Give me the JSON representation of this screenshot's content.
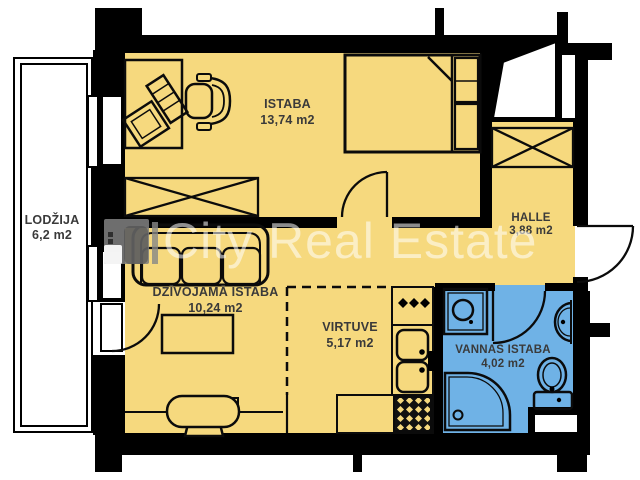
{
  "rooms": {
    "lodzija": {
      "name": "LODŽIJA",
      "area": "6,2 m2"
    },
    "istaba": {
      "name": "ISTABA",
      "area": "13,74 m2"
    },
    "halle": {
      "name": "HALLE",
      "area": "3,88 m2"
    },
    "dzivojama": {
      "name": "DZĪVOJAMĀ ISTABA",
      "area": "10,24 m2"
    },
    "virtuve": {
      "name": "VIRTUVE",
      "area": "5,17 m2"
    },
    "vannas": {
      "name": "VANNAS ISTABA",
      "area": "4,02 m2"
    }
  },
  "watermark": {
    "separator": "|",
    "text": "City Real Estate"
  },
  "colors": {
    "room_fill": "#F6D97E",
    "bathroom_fill": "#6FB2E6",
    "wall": "#000000",
    "label_text": "#3A3A3A",
    "loggia_fill": "#FFFFFF",
    "watermark_text": "rgba(255,255,255,0.55)"
  }
}
